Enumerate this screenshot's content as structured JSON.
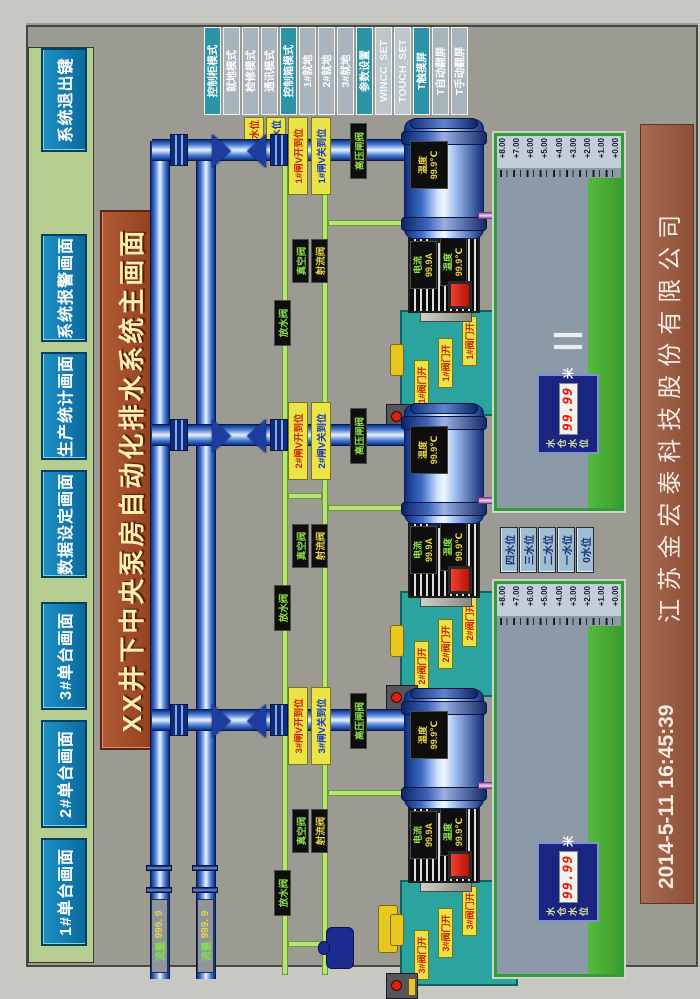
{
  "nav": {
    "buttons": [
      "1#单台画面",
      "2#单台画面",
      "3#单台画面",
      "数据设定画面",
      "生产统计画面",
      "系统报警画面"
    ],
    "exit": "系统退出键"
  },
  "title": "XX井下中央泵房自动化排水系统主画面",
  "modes": [
    "控制柜模式",
    "就地模式",
    "检修模式",
    "通讯模式",
    "控制箱模式",
    "1#就地",
    "2#就地",
    "3#就地",
    "参数设置",
    "WINCC_SET",
    "TOUCH_SET",
    "T触摸屏",
    "T自动翻屏",
    "T手动翻屏"
  ],
  "alarms": [
    "上限水位",
    "下限水位"
  ],
  "flow": [
    {
      "label": "流量",
      "value": "999. 9"
    },
    {
      "label": "流量",
      "value": "999. 9"
    }
  ],
  "units": [
    {
      "id": "1#",
      "valve_open": "1#闸V开到位",
      "valve_close": "1#闸V关到位",
      "gate": "高压闸阀",
      "vacuum": "真空阀",
      "jet": "射流阀",
      "drain": "放水阀",
      "pump_temp_label": "温度",
      "pump_temp": "99.9℃",
      "current_label": "电流",
      "current": "99.9A",
      "motor_temp_label": "温度",
      "motor_temp": "99.9℃",
      "hyd_title": "1#液压站",
      "hyd_valve": "1#阀门开"
    },
    {
      "id": "2#",
      "valve_open": "2#闸V开到位",
      "valve_close": "2#闸V关到位",
      "gate": "高压闸阀",
      "vacuum": "真空阀",
      "jet": "射流阀",
      "drain": "放水阀",
      "pump_temp_label": "温度",
      "pump_temp": "99.9℃",
      "current_label": "电流",
      "current": "99.9A",
      "motor_temp_label": "温度",
      "motor_temp": "99.9℃",
      "hyd_title": "2#液压站",
      "hyd_valve": "2#阀门开"
    },
    {
      "id": "3#",
      "valve_open": "3#闸V开到位",
      "valve_close": "3#闸V关到位",
      "gate": "高压闸阀",
      "vacuum": "真空阀",
      "jet": "射流阀",
      "drain": "放水阀",
      "pump_temp_label": "温度",
      "pump_temp": "99.9℃",
      "current_label": "电流",
      "current": "99.9A",
      "motor_temp_label": "温度",
      "motor_temp": "99.9℃",
      "hyd_title": "3#液压站",
      "hyd_valve": "3#阀门开"
    }
  ],
  "levels": [
    "四水位",
    "三水位",
    "二水位",
    "一水位",
    "0水位"
  ],
  "sumps": [
    {
      "scale": [
        "+8.00",
        "+7.00",
        "+6.00",
        "+5.00",
        "+4.00",
        "+3.00",
        "+2.00",
        "+1.00",
        "+0.00"
      ],
      "gauge": {
        "label1": "水仓",
        "label2": "水位",
        "value": "99.99",
        "unit": "米"
      }
    },
    {
      "scale": [
        "+8.00",
        "+7.00",
        "+6.00",
        "+5.00",
        "+4.00",
        "+3.00",
        "+2.00",
        "+1.00",
        "+0.00"
      ],
      "gauge": {
        "label1": "水仓",
        "label2": "水位",
        "value": "99.99",
        "unit": "米"
      }
    }
  ],
  "footer": {
    "datetime": "2014-5-11  16:45:39",
    "company": "江苏金宏泰科技股份有限公司"
  }
}
